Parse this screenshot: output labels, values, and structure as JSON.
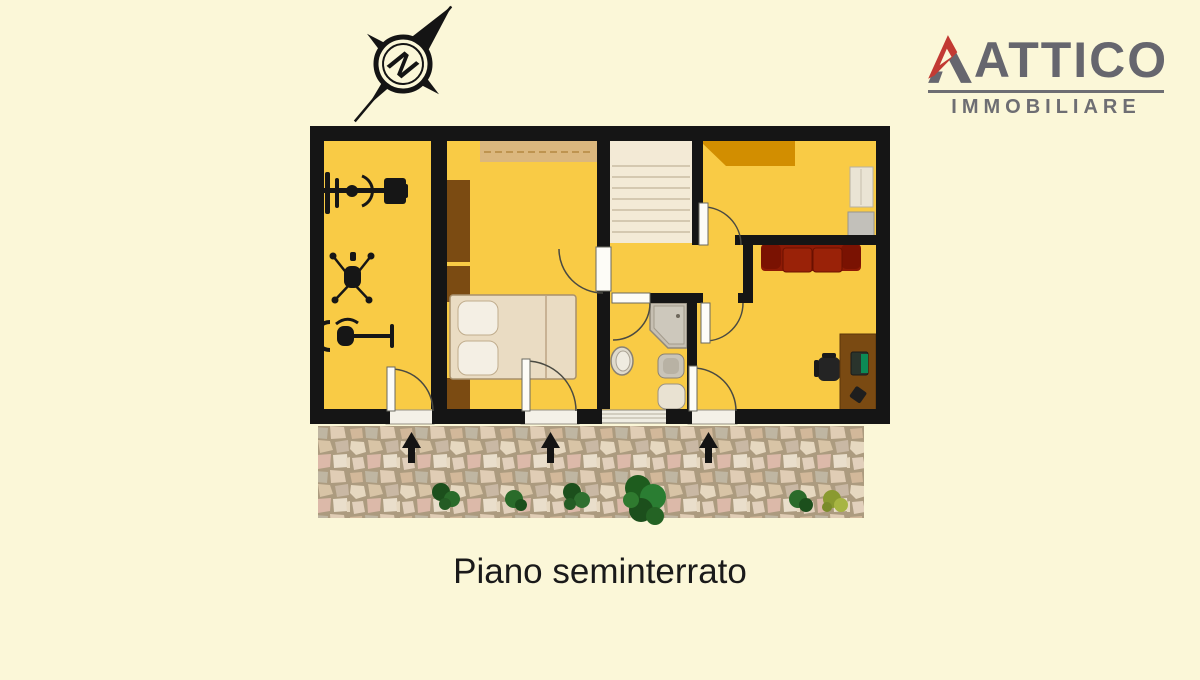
{
  "page": {
    "background_color": "#FBF7D8",
    "caption": "Piano seminterrato"
  },
  "logo": {
    "title": "ATTICO",
    "subtitle": "IMMOBILIARE",
    "accent_color": "#C23A33",
    "text_color": "#66666E"
  },
  "compass": {
    "letter": "N"
  },
  "floor_plan": {
    "colors": {
      "wall": "#151515",
      "floor": "#F9CB45",
      "stairs": "#F3EAD6",
      "wardrobe_dark_wood": "#7B4B12",
      "wardrobe_tan": "#DBB77E",
      "wardrobe_orange": "#D28E00",
      "bed": "#EADCC3",
      "sofa_red": "#8E1A05",
      "desk_wood": "#7A4A12",
      "shower_gray": "#C6BFB2",
      "stone_grout": "#AC9B7F",
      "plant_green": "#2A6B2A"
    },
    "entrance_arrow_count": 3
  }
}
